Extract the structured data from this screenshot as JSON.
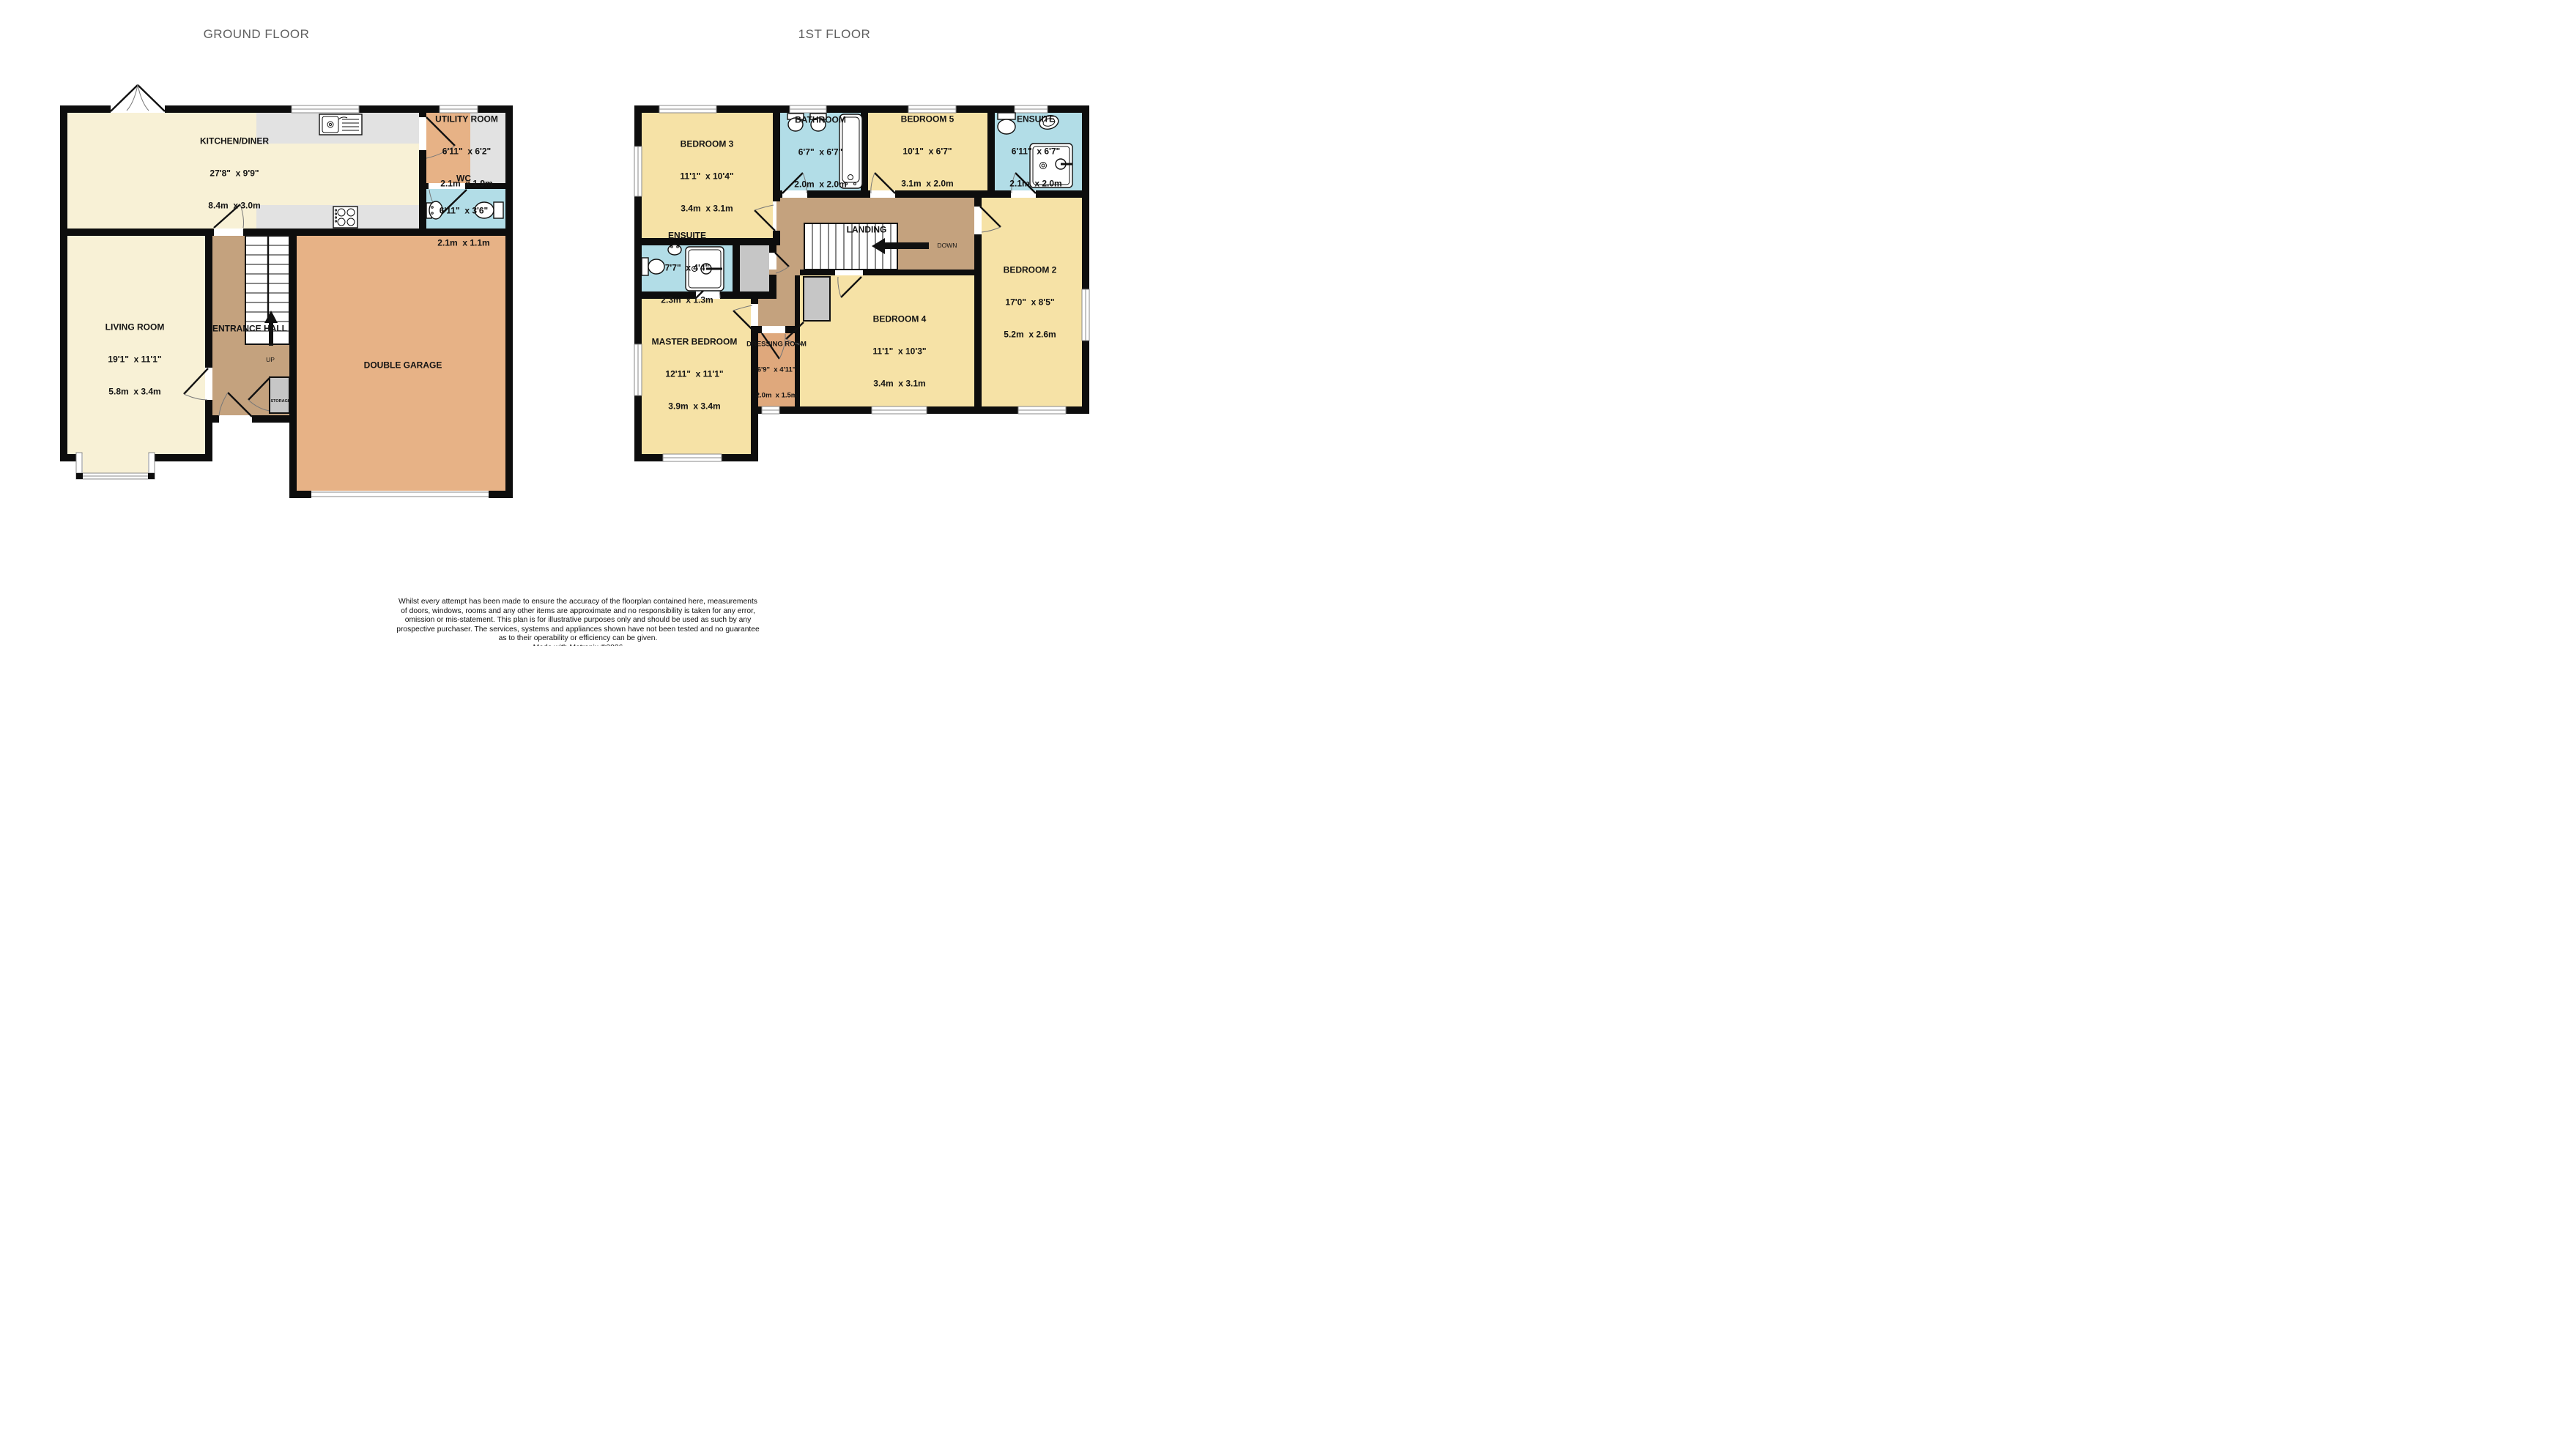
{
  "palette": {
    "wall": "#0d0d0d",
    "cream": "#f8f1d6",
    "yellow": "#f6e2a6",
    "tan": "#c4a27e",
    "orange": "#e7b286",
    "dressing-orange": "#dfa87c",
    "blue": "#b2dde7",
    "counter-gray": "#e2e2e2",
    "closet-gray": "#c6c6c6",
    "winline": "#8a8a8a",
    "title-gray": "#5f5f5f"
  },
  "titles": {
    "ground": "GROUND FLOOR",
    "first": "1ST FLOOR"
  },
  "ground_floor": {
    "rooms": [
      {
        "name": "KITCHEN/DINER",
        "imperial": "27'8\"  x 9'9\"",
        "metric": "8.4m  x 3.0m"
      },
      {
        "name": "UTILITY ROOM",
        "imperial": "6'11\"  x 6'2\"",
        "metric": "2.1m  x 1.9m"
      },
      {
        "name": "WC",
        "imperial": "6'11\"  x 3'6\"",
        "metric": "2.1m  x 1.1m"
      },
      {
        "name": "LIVING ROOM",
        "imperial": "19'1\"  x 11'1\"",
        "metric": "5.8m  x 3.4m"
      },
      {
        "name": "ENTRANCE HALL"
      },
      {
        "name": "DOUBLE GARAGE"
      }
    ],
    "labels": {
      "up": "UP",
      "storage": "STORAGE"
    }
  },
  "first_floor": {
    "rooms": [
      {
        "name": "BEDROOM 3",
        "imperial": "11'1\"  x 10'4\"",
        "metric": "3.4m  x 3.1m"
      },
      {
        "name": "BATHROOM",
        "imperial": "6'7\"  x 6'7\"",
        "metric": "2.0m  x 2.0m"
      },
      {
        "name": "BEDROOM 5",
        "imperial": "10'1\"  x 6'7\"",
        "metric": "3.1m  x 2.0m"
      },
      {
        "name": "ENSUITE",
        "imperial": "6'11\"  x 6'7\"",
        "metric": "2.1m  x 2.0m"
      },
      {
        "name": "ENSUITE",
        "imperial": "7'7\"  x 4'4\"",
        "metric": "2.3m  x 1.3m"
      },
      {
        "name": "LANDING"
      },
      {
        "name": "BEDROOM 2",
        "imperial": "17'0\"  x 8'5\"",
        "metric": "5.2m  x 2.6m"
      },
      {
        "name": "MASTER BEDROOM",
        "imperial": "12'11\"  x 11'1\"",
        "metric": "3.9m  x 3.4m"
      },
      {
        "name": "DRESSING ROOM",
        "imperial": "6'9\"  x 4'11\"",
        "metric": "2.0m  x 1.5m"
      },
      {
        "name": "BEDROOM 4",
        "imperial": "11'1\"  x 10'3\"",
        "metric": "3.4m  x 3.1m"
      }
    ],
    "labels": {
      "down": "DOWN"
    }
  },
  "footer": {
    "disclaimer": "Whilst every attempt has been made to ensure the accuracy of the floorplan contained here, measurements\nof doors, windows, rooms and any other items are approximate and no responsibility is taken for any error,\nomission or mis-statement. This plan is for illustrative purposes only and should be used as such by any\nprospective purchaser. The services, systems and appliances shown have not been tested and no guarantee\nas to their operability or efficiency can be given.",
    "credit": "Made with Metropix ©2026"
  }
}
